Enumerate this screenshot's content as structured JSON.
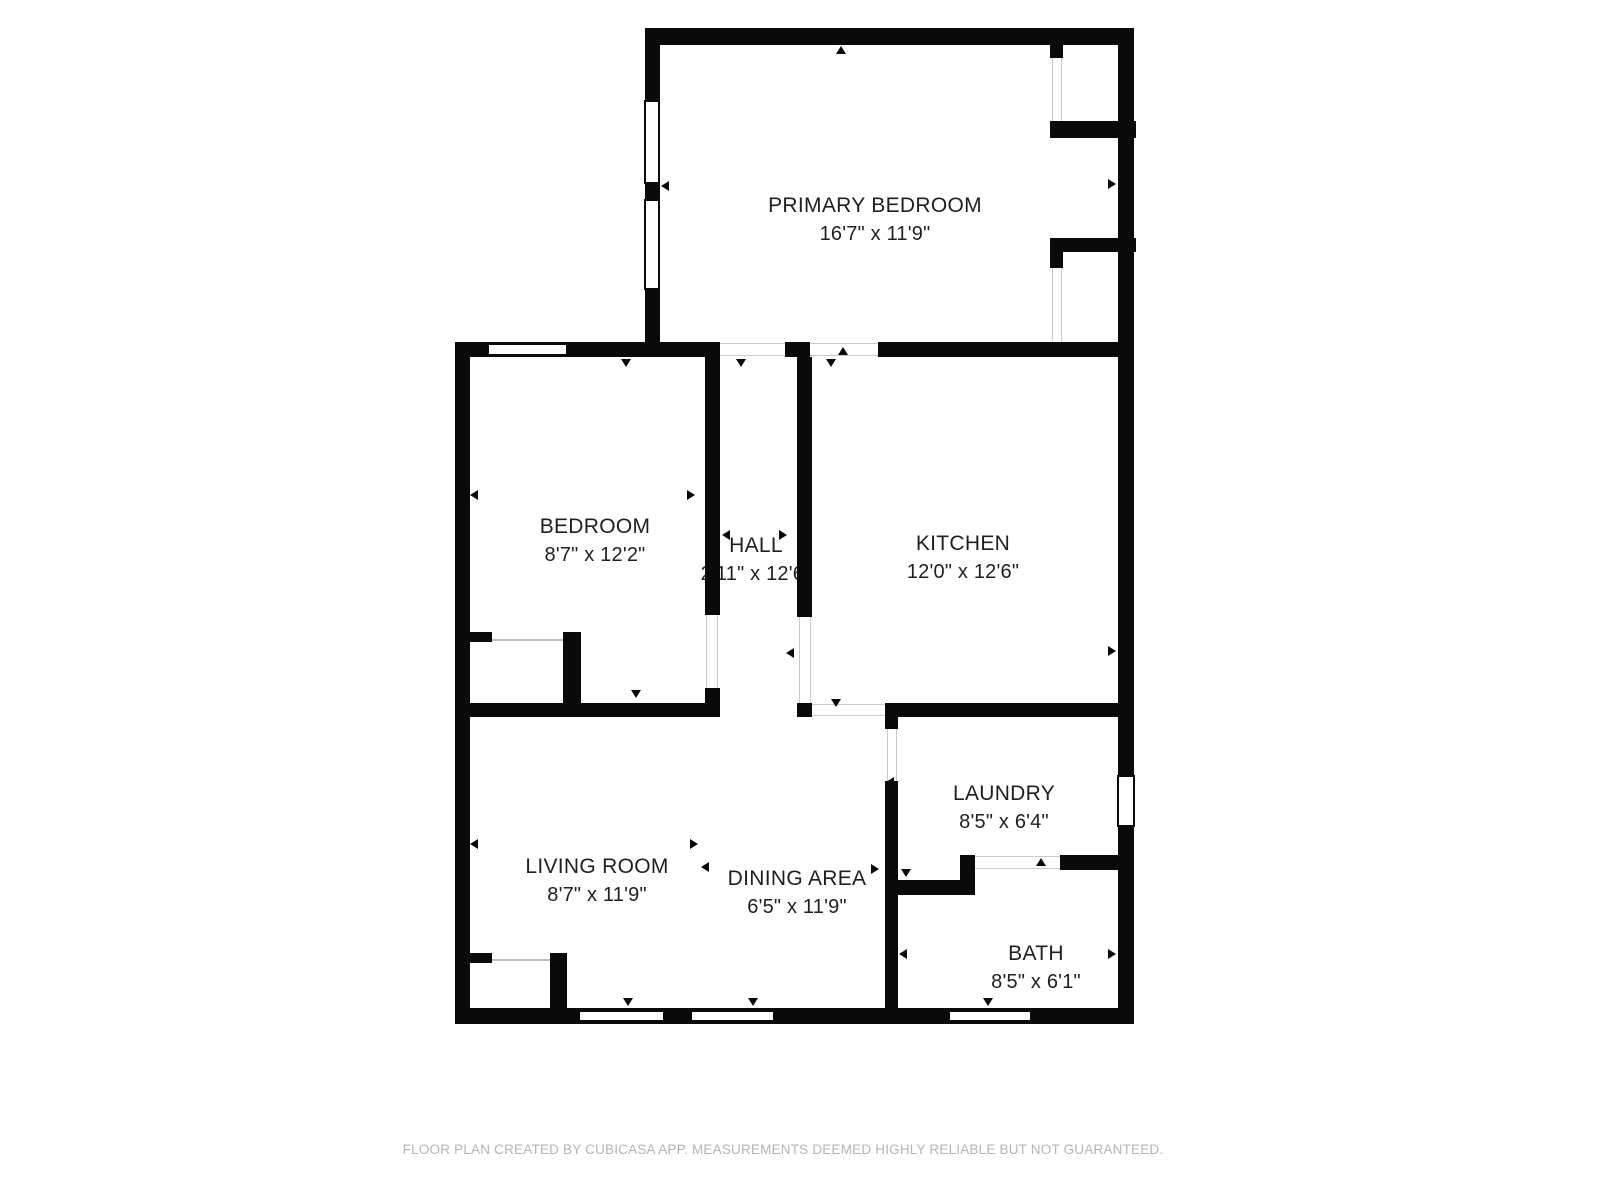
{
  "plan": {
    "rooms": [
      {
        "id": "primary-bedroom",
        "name": "PRIMARY BEDROOM",
        "dims": "16'7\" x 11'9\""
      },
      {
        "id": "bedroom",
        "name": "BEDROOM",
        "dims": "8'7\" x 12'2\""
      },
      {
        "id": "hall",
        "name": "HALL",
        "dims": "2'11\" x 12'6\""
      },
      {
        "id": "kitchen",
        "name": "KITCHEN",
        "dims": "12'0\" x 12'6\""
      },
      {
        "id": "living-room",
        "name": "LIVING ROOM",
        "dims": "8'7\" x 11'9\""
      },
      {
        "id": "dining-area",
        "name": "DINING AREA",
        "dims": "6'5\" x 11'9\""
      },
      {
        "id": "laundry",
        "name": "LAUNDRY",
        "dims": "8'5\" x 6'4\""
      },
      {
        "id": "bath",
        "name": "BATH",
        "dims": "8'5\" x 6'1\""
      }
    ],
    "footer": "FLOOR PLAN CREATED BY CUBICASA APP. MEASUREMENTS DEEMED HIGHLY RELIABLE BUT NOT GUARANTEED.",
    "colors": {
      "wall": "#0a0a0a",
      "label_text": "#1f1f1f",
      "footer_text": "#b4b4b4",
      "background": "#ffffff"
    }
  }
}
